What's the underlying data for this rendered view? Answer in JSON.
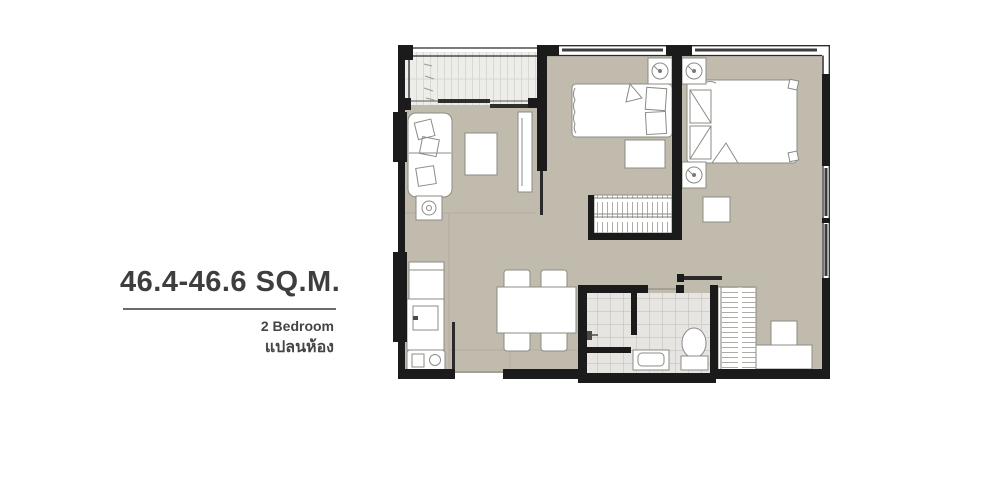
{
  "info": {
    "area_label": "46.4-46.6 SQ.M.",
    "type_label_en": "2 Bedroom",
    "type_label_th": "แปลนห้อง"
  },
  "colors": {
    "floor": "#c1bbae",
    "wall": "#1b1b1b",
    "tile": "#e6e5e1",
    "balcony": "#ededea",
    "furniture": "#ffffff",
    "text": "#3e3e3e"
  },
  "icons": {
    "ac_unit": "ac-unit-icon (square with fan circle), 3 instances",
    "floor_lamp": "floor-lamp-icon (square with spiral circle)"
  }
}
